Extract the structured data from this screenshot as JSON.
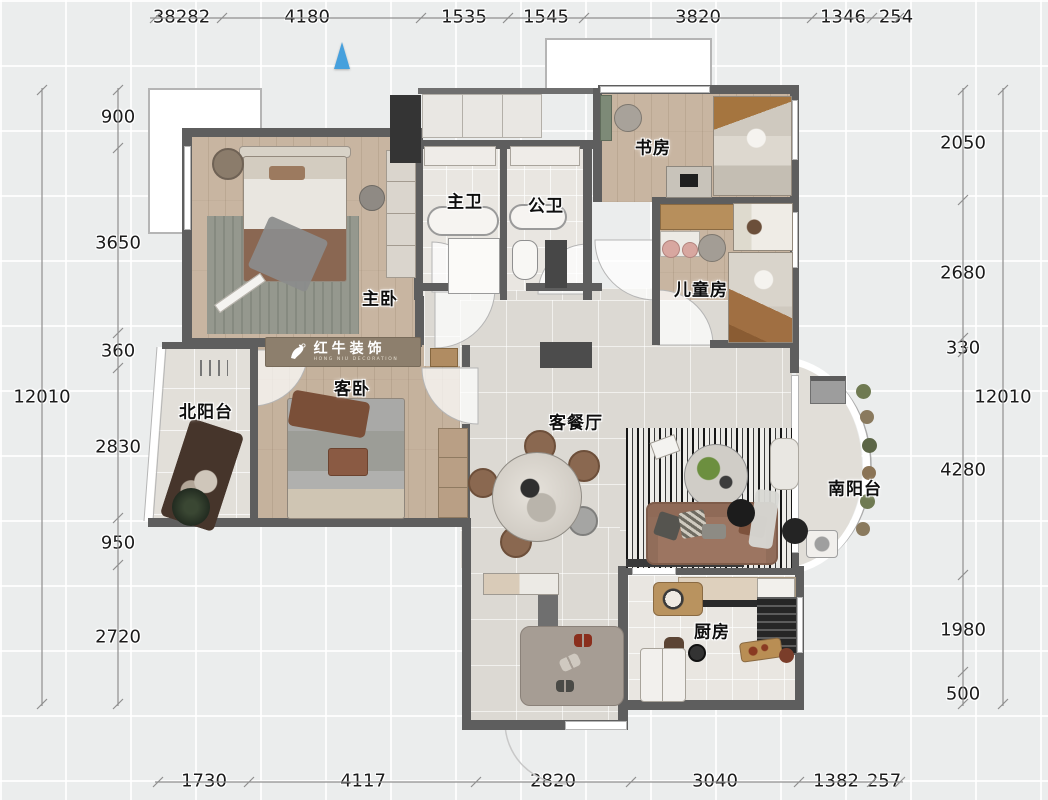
{
  "logo": {
    "brand": "红牛装饰",
    "subtitle": "HONG NIU DECORATION"
  },
  "rooms": {
    "master_bedroom": "主卧",
    "master_bath": "主卫",
    "public_bath": "公卫",
    "study": "书房",
    "kids_room": "儿童房",
    "guest_bedroom": "客卧",
    "north_balcony": "北阳台",
    "living_dining": "客餐厅",
    "south_balcony": "南阳台",
    "kitchen": "厨房"
  },
  "dimensions": {
    "top": [
      "382",
      "282",
      "4180",
      "1535",
      "1545",
      "3820",
      "1346",
      "254"
    ],
    "bottom": [
      "1730",
      "4117",
      "2820",
      "3040",
      "1382",
      "257"
    ],
    "left": [
      "900",
      "3650",
      "360",
      "2830",
      "950",
      "2720"
    ],
    "right": [
      "2050",
      "2680",
      "330",
      "4280",
      "1980",
      "500"
    ],
    "left_total": "12010",
    "right_total": "12010"
  }
}
